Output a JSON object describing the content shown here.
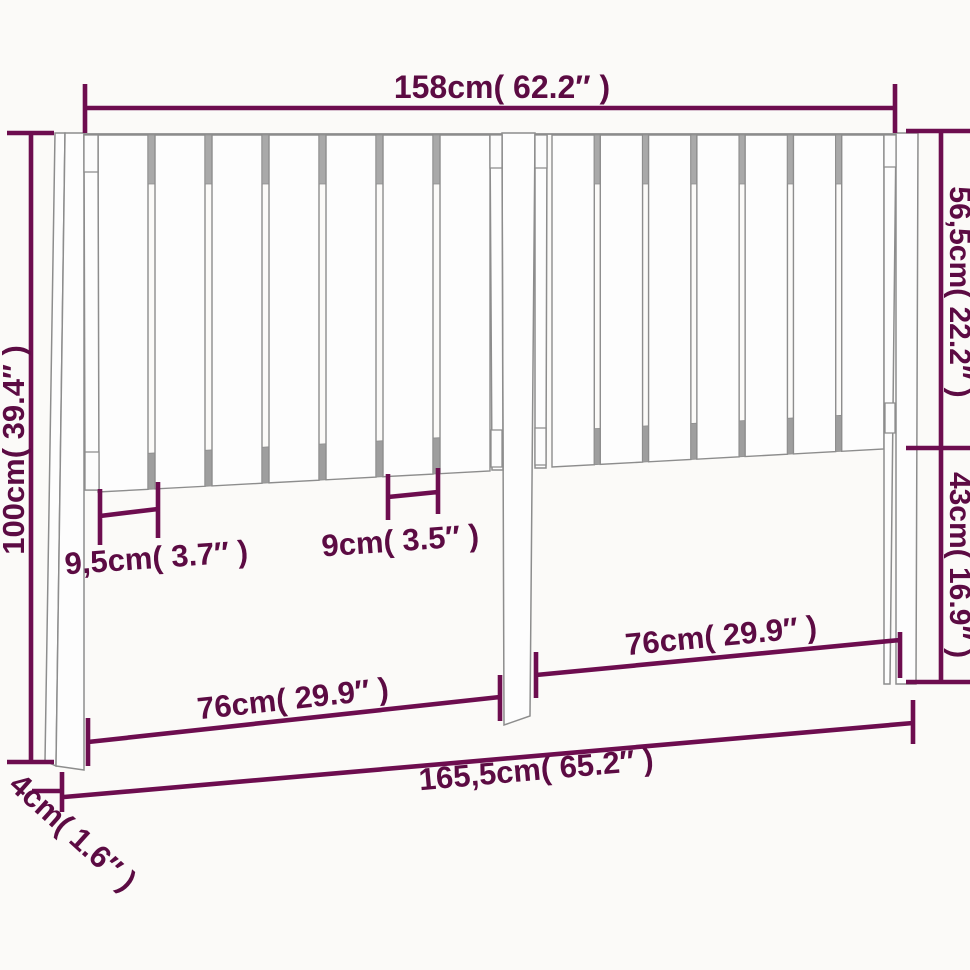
{
  "diagram": {
    "type": "product-dimension-drawing",
    "subject": "slatted-wood-headboard-front-view",
    "background": "#fbfaf8",
    "colors": {
      "dimension_line": "#6d0d4f",
      "dimension_text": "#5c0b43",
      "outline_gray": "#8d8d8d",
      "rail_gray": "#a9a9a9",
      "wood_fill": "#fdfdfd"
    },
    "structure": {
      "sections": [
        {
          "name": "left",
          "slats": 7
        },
        {
          "name": "right",
          "slats": 7
        }
      ],
      "posts": [
        "left",
        "center",
        "right"
      ]
    },
    "labels": {
      "width_top": "158cm( 62.2″ )",
      "height_left": "100cm( 39.4″ )",
      "upper_height_right": "56,5cm( 22.2″ )",
      "lower_height_right": "43cm( 16.9″ )",
      "slat_width": "9,5cm( 3.7″ )",
      "slat_spacing": "9cm( 3.5″ )",
      "span_left": "76cm( 29.9″ )",
      "span_right": "76cm( 29.9″ )",
      "width_total": "165,5cm( 65.2″ )",
      "post_depth": "4cm( 1.6″ )"
    }
  }
}
